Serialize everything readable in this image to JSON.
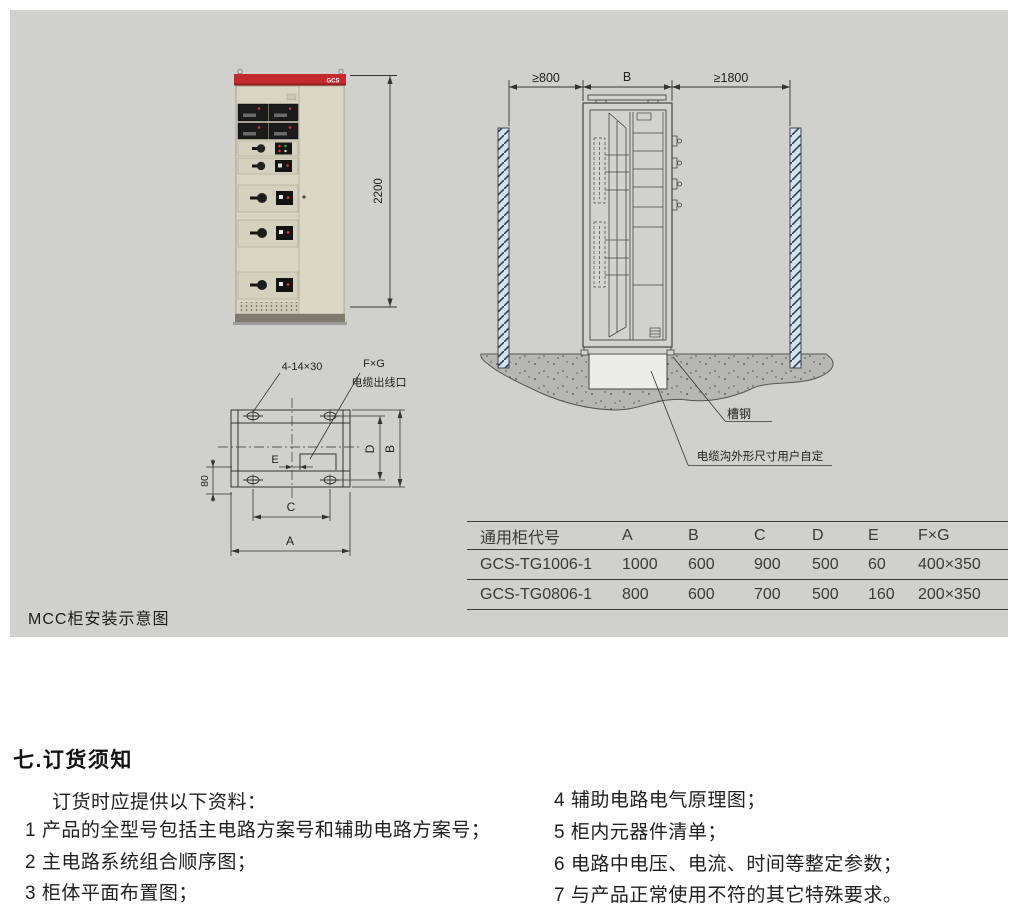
{
  "page": {
    "caption": "MCC柜安装示意图"
  },
  "photo": {
    "brand": "GCS",
    "height_dim": "2200"
  },
  "install": {
    "dim_left": "≥800",
    "dim_mid": "B",
    "dim_right": "≥1800",
    "channel_steel": "槽钢",
    "trench_note": "电缆沟外形尺寸用户自定"
  },
  "plan": {
    "holes": "4-14×30",
    "fxg": "F×G",
    "outlet": "电缆出线口",
    "dim_a": "A",
    "dim_b": "B",
    "dim_c": "C",
    "dim_d": "D",
    "dim_e": "E",
    "dim_80": "80"
  },
  "table": {
    "headers": [
      "通用柜代号",
      "A",
      "B",
      "C",
      "D",
      "E",
      "F×G"
    ],
    "rows": [
      [
        "GCS-TG1006-1",
        "1000",
        "600",
        "900",
        "500",
        "60",
        "400×350"
      ],
      [
        "GCS-TG0806-1",
        "800",
        "600",
        "700",
        "500",
        "160",
        "200×350"
      ]
    ]
  },
  "order": {
    "heading": "七.订货须知",
    "intro": "订货时应提供以下资料：",
    "items_left": [
      "1 产品的全型号包括主电路方案号和辅助电路方案号；",
      "2 主电路系统组合顺序图；",
      "3 柜体平面布置图；"
    ],
    "items_right": [
      "4 辅助电路电气原理图；",
      "5 柜内元器件清单；",
      "6 电路中电压、电流、时间等整定参数；",
      "7 与产品正常使用不符的其它特殊要求。"
    ]
  },
  "colors": {
    "panel_bg": "#d0d0ce",
    "accent_red": "#c4292c",
    "wall_blue": "#cfe4f0",
    "ground": "#b6b6b4"
  }
}
